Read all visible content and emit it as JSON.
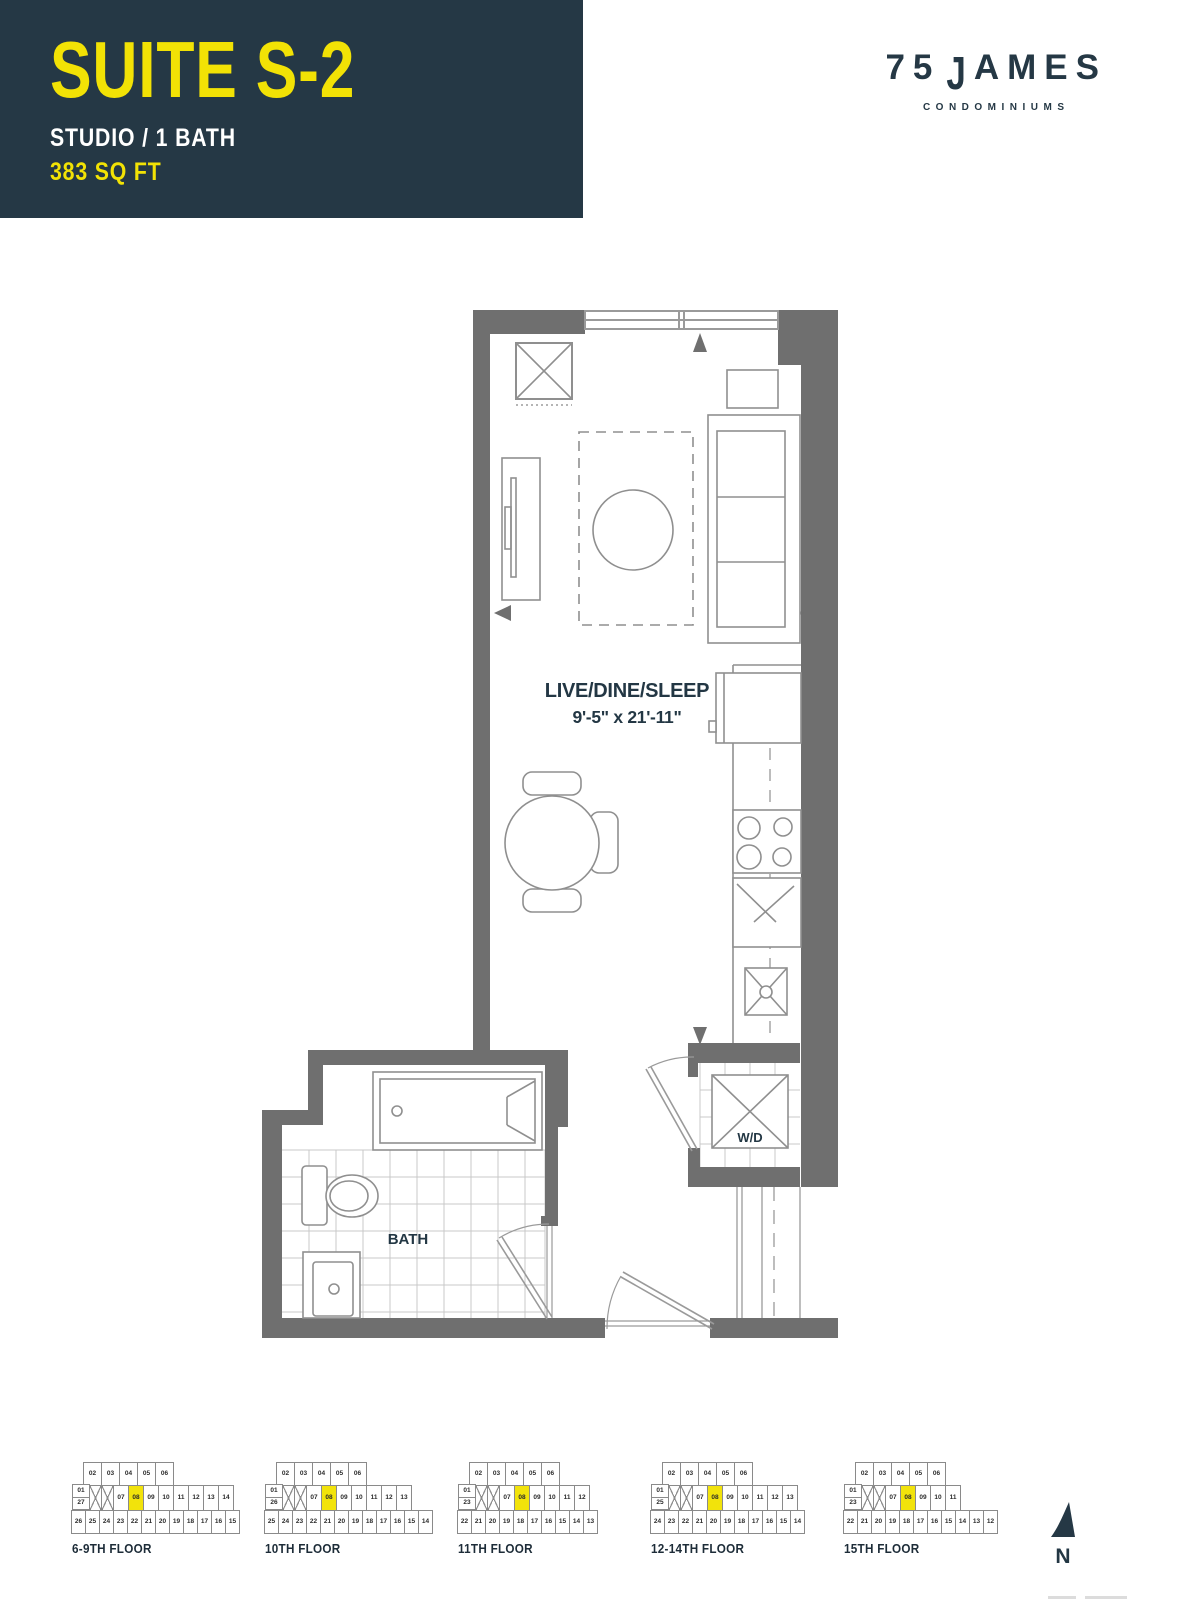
{
  "header": {
    "suite_name": "SUITE S-2",
    "suite_type": "STUDIO / 1 BATH",
    "suite_area": "383 SQ FT"
  },
  "logo": {
    "number": "75",
    "j": "J",
    "ames": "AMES",
    "tagline": "CONDOMINIUMS"
  },
  "plan": {
    "room_label": "LIVE/DINE/SLEEP",
    "room_dims": "9'-5\" x 21'-11\"",
    "bath_label": "BATH",
    "wd_label": "W/D"
  },
  "compass": {
    "label": "N"
  },
  "keyplans": [
    {
      "label": "6-9TH FLOOR",
      "top": [
        "02",
        "03",
        "04",
        "05",
        "06"
      ],
      "left_stack": [
        "01",
        "27"
      ],
      "units": [
        "07",
        "08",
        "09",
        "10",
        "11",
        "12",
        "13",
        "14"
      ],
      "highlight": "08",
      "bottom": [
        "26",
        "25",
        "24",
        "23",
        "22",
        "21",
        "20",
        "19",
        "18",
        "17",
        "16",
        "15"
      ]
    },
    {
      "label": "10TH FLOOR",
      "top": [
        "02",
        "03",
        "04",
        "05",
        "06"
      ],
      "left_stack": [
        "01",
        "26"
      ],
      "units": [
        "07",
        "08",
        "09",
        "10",
        "11",
        "12",
        "13"
      ],
      "highlight": "08",
      "bottom": [
        "25",
        "24",
        "23",
        "22",
        "21",
        "20",
        "19",
        "18",
        "17",
        "16",
        "15",
        "14"
      ]
    },
    {
      "label": "11TH FLOOR",
      "top": [
        "02",
        "03",
        "04",
        "05",
        "06"
      ],
      "left_stack": [
        "01",
        "23"
      ],
      "units": [
        "07",
        "08",
        "09",
        "10",
        "11",
        "12"
      ],
      "highlight": "08",
      "bottom": [
        "22",
        "21",
        "20",
        "19",
        "18",
        "17",
        "16",
        "15",
        "14",
        "13"
      ]
    },
    {
      "label": "12-14TH FLOOR",
      "top": [
        "02",
        "03",
        "04",
        "05",
        "06"
      ],
      "left_stack": [
        "01",
        "25"
      ],
      "units": [
        "07",
        "08",
        "09",
        "10",
        "11",
        "12",
        "13"
      ],
      "highlight": "08",
      "bottom": [
        "24",
        "23",
        "22",
        "21",
        "20",
        "19",
        "18",
        "17",
        "16",
        "15",
        "14"
      ]
    },
    {
      "label": "15TH FLOOR",
      "top": [
        "02",
        "03",
        "04",
        "05",
        "06"
      ],
      "left_stack": [
        "01",
        "23"
      ],
      "units": [
        "07",
        "08",
        "09",
        "10",
        "11"
      ],
      "highlight": "08",
      "bottom": [
        "22",
        "21",
        "20",
        "19",
        "18",
        "17",
        "16",
        "15",
        "14",
        "13",
        "12"
      ]
    }
  ],
  "colors": {
    "navy": "#253845",
    "yellow": "#F2E205",
    "highlight_yellow": "#F2E30B",
    "wall_gray": "#6F6F6F",
    "line_gray": "#8F8F8F"
  }
}
